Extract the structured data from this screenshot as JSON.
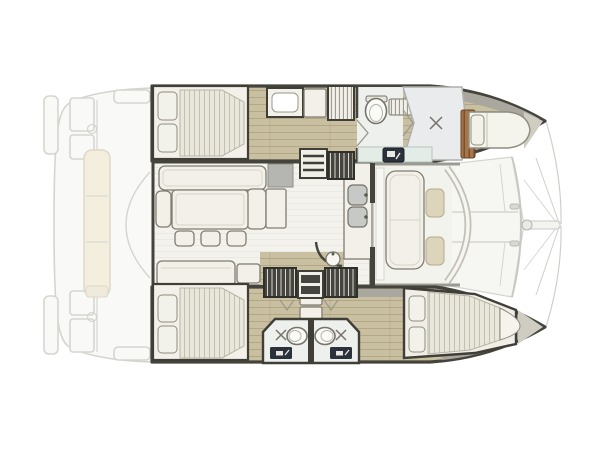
{
  "meta": {
    "title": "Catamaran interior layout plan",
    "description": "Top-down 2D floor plan of a sailing catamaran: two hulls with cabins and bathrooms, central saloon with L-sofa, dining table and galley, forward cockpit lounge, aft cockpit deck at stern and trampoline with bowsprit at bow."
  },
  "palette": {
    "bg": "#ffffff",
    "wall": "#45443c",
    "wallDark": "#3f3e37",
    "wood": "#c9bfa1",
    "saloonFloor": "#f3f2ec",
    "furniture": "#f2f0e8",
    "furnitureLine": "#807e72",
    "mattress": "#e9e7dc",
    "pillow": "#f3f2ea",
    "outlineSoft": "#8f8d80",
    "cushion": "#dcd5bc",
    "cushionLine": "#b3ab8d",
    "deckGray": "#a9a79e",
    "blockGray": "#b5b5b1",
    "showerFloor": "#e9ebec",
    "bathFloor": "#eef0ee",
    "fixtureLine": "#75736a",
    "teak": "#a5764b",
    "teakLine": "#6e4526",
    "seafoam": "#e3ece6",
    "appliance": "#2c323c",
    "stairDark": "#45443e",
    "stairLight": "#d8d7ce",
    "faintLine": "#d5d5d0",
    "faintFill": "#f9f9f7",
    "cream": "#f3eedd",
    "creamLine": "#ddd8c4",
    "tramp": "#cfcfca"
  },
  "symbols": {
    "double_bed": "double berth with two pillows and striped mattress",
    "toilet": "oval toilet bowl",
    "shower": "shower pan marked with X",
    "sink": "rounded basin with faucet dot",
    "stairs": "companionway steps / coil ladder",
    "teak_grating": "teak slatted grating",
    "trampoline": "bow trampoline rigging lines"
  },
  "areas": [
    "aft-cockpit-deck",
    "port-hull-aft-cabin",
    "port-hull-galley",
    "port-hull-bathroom",
    "port-hull-bow-berth",
    "saloon-lounge-dining",
    "saloon-galley",
    "forward-cockpit-lounge",
    "starboard-hull-aft-cabin",
    "starboard-hull-bathrooms",
    "starboard-hull-forward-cabin",
    "foredeck-trampoline"
  ]
}
